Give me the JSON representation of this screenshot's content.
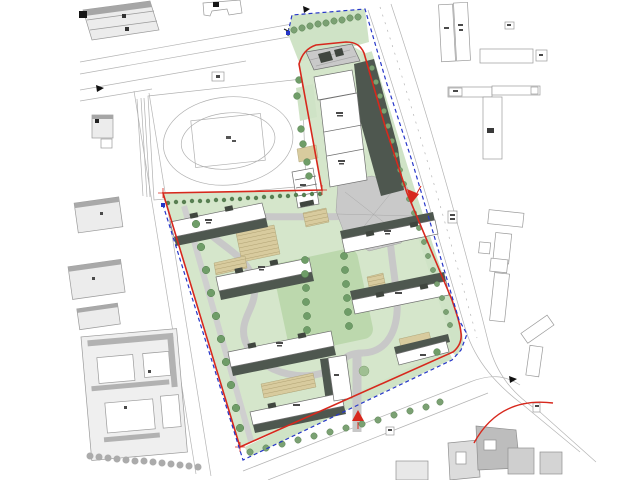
{
  "document": {
    "kind": "architectural-site-plan",
    "background": "#ffffff"
  },
  "colors": {
    "site_boundary_red": "#d7281d",
    "context_boundary_blue": "#2636c8",
    "site_green": "#d5e6cb",
    "lawn_green": "#bcd8ad",
    "verge_green": "#cfe3c6",
    "tree_green": "#6f9d68",
    "tree_small_green": "#7ba173",
    "tree_dark_green": "#587f52",
    "hedge_gray": "#ababab",
    "building_shadow": "#4e574f",
    "roof_dark": "#40463f",
    "road_gray": "#c8c8c8",
    "plaza_gray": "#c9c9c9",
    "parking_tan": "#d8cb9e",
    "context_building_gray": "#ececec",
    "context_line_gray": "#b4b4b4",
    "arrow_red": "#d7281d"
  },
  "boundaries": {
    "site": {
      "style": "solid",
      "color": "#d7281d"
    },
    "planning_context": {
      "style": "dashed",
      "color": "#2636c8"
    }
  },
  "markers": {
    "east_entrance": "red-arrow-icon",
    "south_entrance": "red-arrow-icon",
    "road_direction": "black-arrow-icon",
    "turning_curve": "red-arc"
  },
  "landmarks": {
    "running_track": "athletics-oval-north-west",
    "central_lawn": "courtyard-lawn",
    "plaza": "paved-junction",
    "residential_rows": 8,
    "tower_group_north": 1
  }
}
